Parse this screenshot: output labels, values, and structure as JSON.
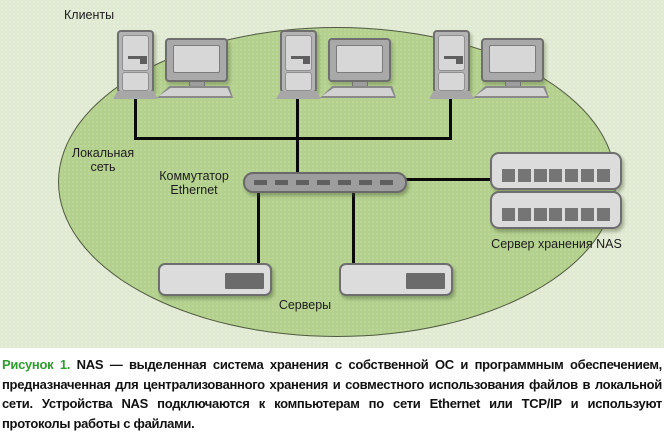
{
  "diagram": {
    "labels": {
      "clients": "Клиенты",
      "local_network_line1": "Локальная",
      "local_network_line2": "сеть",
      "switch_line1": "Коммутатор",
      "switch_line2": "Ethernet",
      "nas": "Сервер хранения NAS",
      "servers": "Серверы"
    },
    "counts": {
      "client_workstations": 3,
      "nas_units": 2,
      "nas_ports_per_unit": 7,
      "servers": 2
    },
    "colors": {
      "outer_background": "#e0e9d1",
      "ellipse_fill": "#b3d08d",
      "ellipse_border": "#4f5a40",
      "wire": "#0a0a0a",
      "device_fill": "#dcdcdc",
      "device_border": "#6e6e6e",
      "device_dark_detail": "#6b6b6b",
      "caption_label_green": "#2e9e2f"
    }
  },
  "caption": {
    "figure_label": "Рисунок 1.",
    "text": "NAS — выделенная система хранения с собственной ОС и программным обеспечением, предназначенная для централизованного хранения и совместного использования файлов в локальной сети. Устройства NAS подключаются к компьютерам по сети Ethernet или TCP/IP и используют протоколы работы с файлами."
  }
}
